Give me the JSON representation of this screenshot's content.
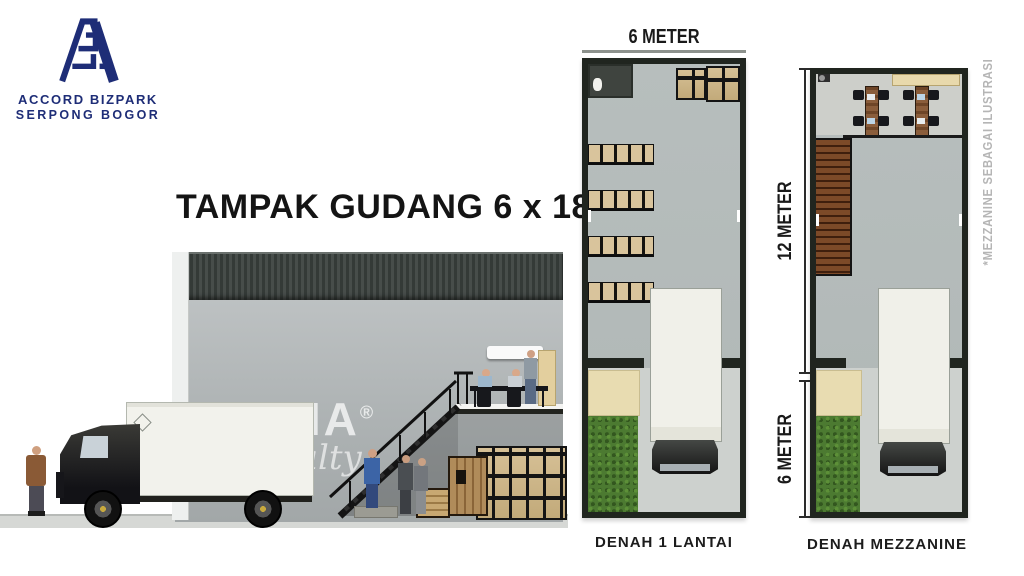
{
  "logo": {
    "monogram_icon": "accord-a-monogram",
    "line1": "ACCORD BIZPARK",
    "line2": "SERPONG BOGOR",
    "brand_color": "#1e2d77"
  },
  "title": "TAMPAK GUDANG 6 x 18",
  "watermark": {
    "name": "NPRAMA",
    "registered": "®",
    "tagline": "Realty"
  },
  "plans": {
    "floor1": {
      "caption": "DENAH 1 LANTAI",
      "width_label": "6 METER"
    },
    "mezzanine": {
      "caption": "DENAH MEZZANINE",
      "depth_label": "12 METER",
      "front_label": "6 METER"
    }
  },
  "side_note": "*MEZZANINE SEBAGAI ILUSTRASI",
  "colors": {
    "brand_navy": "#1e2d77",
    "text_black": "#1a1a1a",
    "note_gray": "#b5b5b5",
    "grass_green": "#4c7a31",
    "box_beige": "#d8c49c",
    "wood_brown": "#7c4a28",
    "plan_wall": "#20251f",
    "fascia_dark": "#3c423f",
    "dimension_line": "#8d928d"
  }
}
